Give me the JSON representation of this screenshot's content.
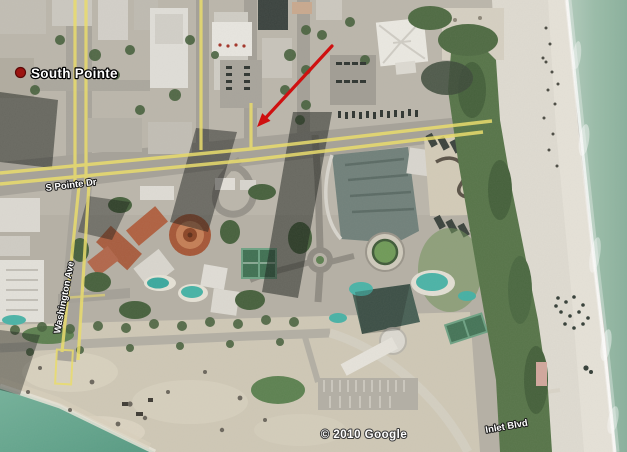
{
  "map": {
    "labels": {
      "place": "South Pointe",
      "street_s_pointe": "S Pointe Dr",
      "street_washington": "Washington Ave",
      "street_inlet": "Inlet Blvd"
    },
    "attribution": "© 2010 Google",
    "colors": {
      "road_overlay": "#e9dc6d",
      "arrow": "#cf1010",
      "marker": "#9c1410",
      "ocean": "#97baa8",
      "channel_water": "#63a68e",
      "sand": "#dfdbd1",
      "label_text": "#ffffff"
    }
  }
}
